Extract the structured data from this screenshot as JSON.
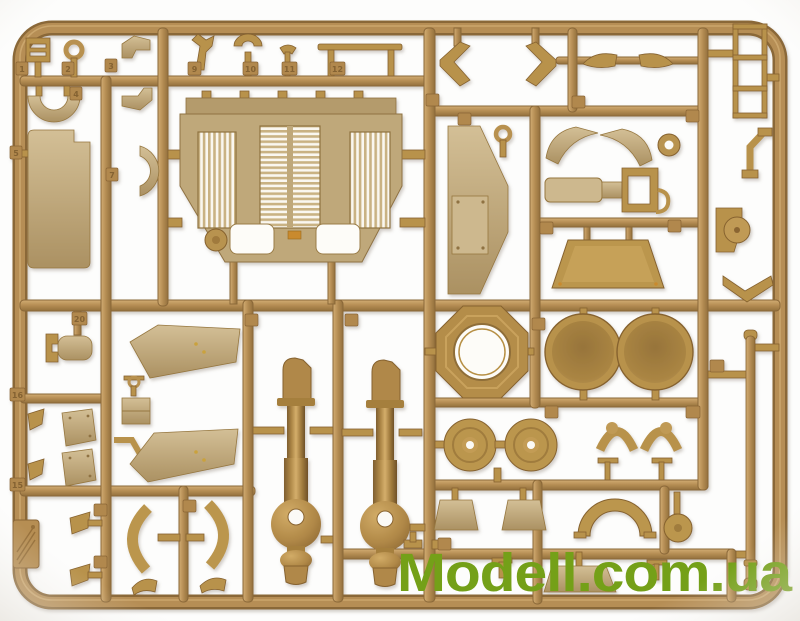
{
  "photo": {
    "subject": "tan injection-molded plastic model kit sprue with military vehicle parts on a white background",
    "background_color": "#fdfdfc",
    "vignette_color": "#e3dfd8",
    "sprue_runner_color": "#b3894e",
    "sprue_shadow_color": "#8a6738",
    "part_light_color": "#c9b48a",
    "part_dark_color": "#b8924c"
  },
  "watermark": {
    "text": "Modell.com.ua",
    "color": "#74a018"
  },
  "tags": {
    "t1": "1",
    "t2": "2",
    "t3": "3",
    "t4": "4",
    "t5": "5",
    "t7": "7",
    "t9": "9",
    "t10": "10",
    "t11": "11",
    "t12": "12",
    "t15": "15",
    "t16": "16",
    "t20": "20"
  },
  "parts": [
    "sight-bracket",
    "ring-pin",
    "angle-bracket",
    "half-disc",
    "side-panel",
    "half-ring",
    "spiked-clamp",
    "u-clamp",
    "y-clamp",
    "tow-bar",
    "engine-deck-with-louvers",
    "wishbone-arm-left",
    "wishbone-arm-right",
    "airfoil-stay-left",
    "airfoil-stay-right",
    "ladder-frame",
    "hull-side-panel",
    "ring-key",
    "fender-half-left",
    "fender-half-right",
    "washer-ring",
    "exhaust-assembly",
    "bent-pipe-bracket",
    "trapezoid-tray",
    "pulley-mount",
    "v-bracket",
    "tow-coupling",
    "ring-pin-small",
    "junction-box",
    "elbow-pipe",
    "wedge-pair",
    "mudflap-pair",
    "sloped-fender-upper",
    "sloped-fender-lower",
    "recoil-cylinder-left",
    "recoil-cylinder-right",
    "octagon-ring",
    "hatch-dish-left",
    "hatch-dish-right",
    "wheel-disc-left",
    "wheel-disc-right",
    "arch-bracket-pair",
    "t-post-pair",
    "maker-logo-plate",
    "curved-arc-pair",
    "foot-pair",
    "trapezoid-bracket-pair",
    "fender-arch",
    "idler-disc",
    "small-trapezoid",
    "long-rod"
  ]
}
